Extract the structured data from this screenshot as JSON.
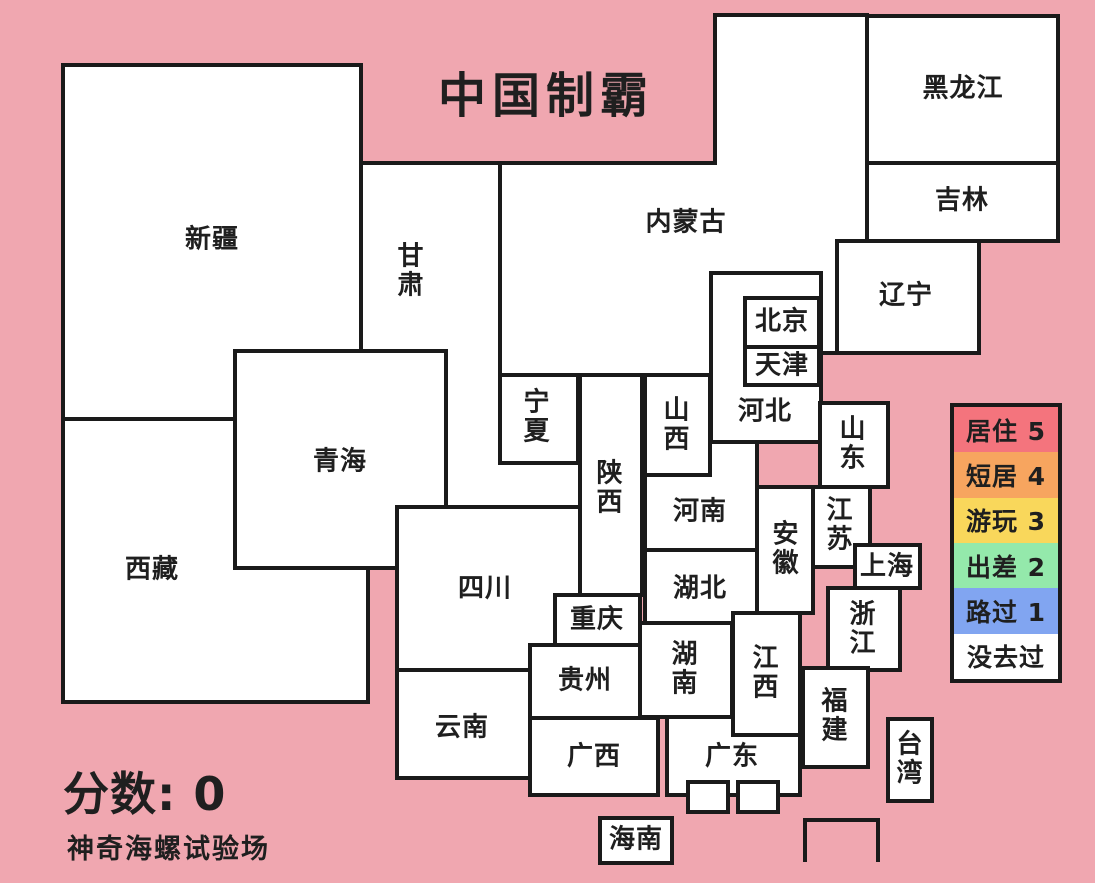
{
  "title": "中国制霸",
  "score": {
    "text": "分数: 0",
    "x": 63,
    "y": 758
  },
  "footer": {
    "text": "神奇海螺试验场",
    "x": 67,
    "y": 827
  },
  "colors": {
    "background": "#F0A7B0",
    "province_fill": "#FFFFFF",
    "border": "#1A1A1A",
    "text": "#1F1F1F"
  },
  "legend": {
    "x": 950,
    "y": 403,
    "width": 112,
    "height": 280,
    "items": [
      {
        "label": "居住 5",
        "color": "#F4747D"
      },
      {
        "label": "短居 4",
        "color": "#F7A55F"
      },
      {
        "label": "游玩 3",
        "color": "#F9D75B"
      },
      {
        "label": "出差 2",
        "color": "#94E9AB"
      },
      {
        "label": "路过 1",
        "color": "#81A5F1"
      },
      {
        "label": "没去过",
        "color": "#FFFFFF"
      }
    ]
  },
  "provinces": [
    {
      "id": "xinjiang",
      "label": "新疆",
      "stack": false,
      "rect": [
        63,
        65,
        298,
        354
      ],
      "labelPos": [
        212,
        240
      ]
    },
    {
      "id": "xizang",
      "label": "西藏",
      "stack": false,
      "rect": [
        63,
        419,
        305,
        283
      ],
      "labelPos": [
        152,
        570
      ]
    },
    {
      "id": "gansu",
      "label": "甘肃",
      "stack": true,
      "rect": [
        361,
        163,
        219,
        344
      ],
      "labelPos": [
        411,
        271
      ]
    },
    {
      "id": "qinghai",
      "label": "青海",
      "stack": false,
      "rect": [
        235,
        351,
        211,
        217
      ],
      "labelPos": [
        340,
        462
      ]
    },
    {
      "id": "neimenggu",
      "label": "内蒙古",
      "stack": false,
      "points": [
        [
          715,
          15
        ],
        [
          867,
          15
        ],
        [
          867,
          241
        ],
        [
          837,
          241
        ],
        [
          837,
          353
        ],
        [
          821,
          353
        ],
        [
          821,
          273
        ],
        [
          711,
          273
        ],
        [
          711,
          375
        ],
        [
          500,
          375
        ],
        [
          500,
          163
        ],
        [
          715,
          163
        ]
      ],
      "labelPos": [
        686,
        223
      ]
    },
    {
      "id": "heilongjiang",
      "label": "黑龙江",
      "stack": false,
      "rect": [
        867,
        16,
        191,
        147
      ],
      "labelPos": [
        963,
        89
      ]
    },
    {
      "id": "jilin",
      "label": "吉林",
      "stack": false,
      "rect": [
        867,
        163,
        191,
        78
      ],
      "labelPos": [
        962,
        201
      ]
    },
    {
      "id": "liaoning",
      "label": "辽宁",
      "stack": false,
      "rect": [
        837,
        241,
        142,
        112
      ],
      "labelPos": [
        906,
        296
      ]
    },
    {
      "id": "ningxia",
      "label": "宁夏",
      "stack": true,
      "rect": [
        500,
        375,
        78,
        88
      ],
      "labelPos": [
        537,
        417
      ]
    },
    {
      "id": "henan",
      "label": "河南",
      "stack": false,
      "rect": [
        645,
        442,
        112,
        108
      ],
      "labelPos": [
        700,
        512
      ]
    },
    {
      "id": "shanxi",
      "label": "山西",
      "stack": true,
      "rect": [
        645,
        375,
        65,
        100
      ],
      "labelPos": [
        677,
        425
      ]
    },
    {
      "id": "hebei",
      "label": "河北",
      "stack": false,
      "rect": [
        711,
        273,
        110,
        169
      ],
      "labelPos": [
        765,
        412
      ]
    },
    {
      "id": "beijing",
      "label": "北京",
      "stack": false,
      "rect": [
        745,
        298,
        74,
        49
      ],
      "labelPos": [
        782,
        322
      ]
    },
    {
      "id": "tianjin",
      "label": "天津",
      "stack": false,
      "rect": [
        745,
        347,
        74,
        38
      ],
      "labelPos": [
        782,
        366
      ]
    },
    {
      "id": "shandong",
      "label": "山东",
      "stack": true,
      "rect": [
        820,
        403,
        68,
        84
      ],
      "labelPos": [
        853,
        444
      ]
    },
    {
      "id": "jiangsu",
      "label": "江苏",
      "stack": true,
      "rect": [
        812,
        487,
        58,
        80
      ],
      "labelPos": [
        840,
        525
      ]
    },
    {
      "id": "anhui",
      "label": "安徽",
      "stack": true,
      "rect": [
        757,
        487,
        56,
        126
      ],
      "labelPos": [
        786,
        549
      ]
    },
    {
      "id": "shanghai",
      "label": "上海",
      "stack": false,
      "rect": [
        855,
        545,
        65,
        43
      ],
      "labelPos": [
        887,
        567
      ]
    },
    {
      "id": "zhejiang",
      "label": "浙江",
      "stack": true,
      "rect": [
        828,
        588,
        72,
        82
      ],
      "labelPos": [
        863,
        629
      ]
    },
    {
      "id": "sichuan",
      "label": "四川",
      "stack": false,
      "rect": [
        397,
        507,
        183,
        163
      ],
      "labelPos": [
        485,
        589
      ]
    },
    {
      "id": "shaanxi",
      "label": "陕西",
      "stack": true,
      "rect": [
        580,
        375,
        62,
        220
      ],
      "labelPos": [
        610,
        488
      ]
    },
    {
      "id": "chongqing",
      "label": "重庆",
      "stack": false,
      "rect": [
        555,
        595,
        85,
        50
      ],
      "labelPos": [
        597,
        620
      ]
    },
    {
      "id": "hubei",
      "label": "湖北",
      "stack": false,
      "rect": [
        645,
        550,
        112,
        77
      ],
      "labelPos": [
        700,
        589
      ]
    },
    {
      "id": "guizhou",
      "label": "贵州",
      "stack": false,
      "rect": [
        530,
        645,
        110,
        73
      ],
      "labelPos": [
        585,
        681
      ]
    },
    {
      "id": "yunnan",
      "label": "云南",
      "stack": false,
      "rect": [
        397,
        670,
        133,
        108
      ],
      "labelPos": [
        462,
        728
      ]
    },
    {
      "id": "guangxi",
      "label": "广西",
      "stack": false,
      "rect": [
        530,
        718,
        128,
        77
      ],
      "labelPos": [
        594,
        757
      ]
    },
    {
      "id": "hunan",
      "label": "湖南",
      "stack": true,
      "rect": [
        640,
        623,
        92,
        94
      ],
      "labelPos": [
        685,
        669
      ]
    },
    {
      "id": "guangdong",
      "label": "广东",
      "stack": false,
      "rect": [
        667,
        717,
        133,
        78
      ],
      "labelPos": [
        732,
        757
      ]
    },
    {
      "id": "jiangxi",
      "label": "江西",
      "stack": true,
      "rect": [
        733,
        613,
        67,
        122
      ],
      "labelPos": [
        766,
        673
      ]
    },
    {
      "id": "fujian",
      "label": "福建",
      "stack": true,
      "rect": [
        803,
        668,
        65,
        99
      ],
      "labelPos": [
        835,
        716
      ]
    },
    {
      "id": "taiwan",
      "label": "台湾",
      "stack": true,
      "rect": [
        888,
        719,
        44,
        82
      ],
      "labelPos": [
        910,
        759
      ]
    },
    {
      "id": "hainan",
      "label": "海南",
      "stack": false,
      "rect": [
        600,
        818,
        72,
        45
      ],
      "labelPos": [
        636,
        840
      ]
    },
    {
      "id": "hongkong",
      "label": "",
      "stack": false,
      "rect": [
        688,
        782,
        40,
        30
      ],
      "labelPos": [
        708,
        797
      ]
    },
    {
      "id": "macau",
      "label": "",
      "stack": false,
      "rect": [
        738,
        782,
        40,
        30
      ],
      "labelPos": [
        758,
        797
      ]
    }
  ],
  "south_sea_box": {
    "points": [
      [
        805,
        862
      ],
      [
        805,
        820
      ],
      [
        878,
        820
      ],
      [
        878,
        862
      ]
    ]
  }
}
